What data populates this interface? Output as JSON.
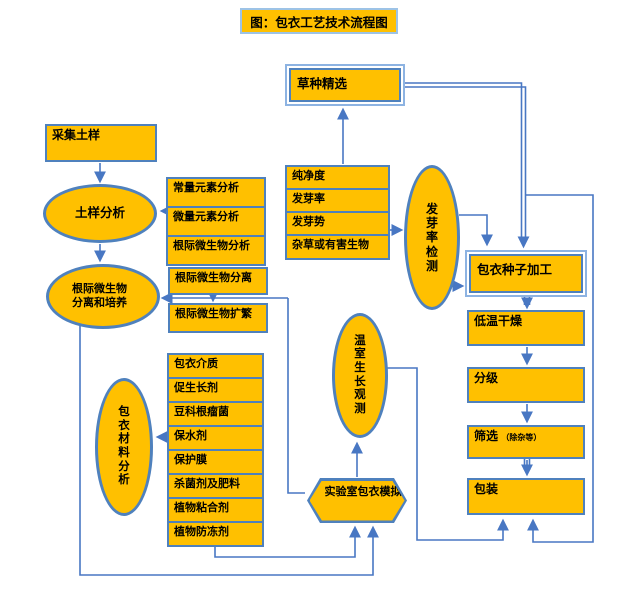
{
  "title": "图：包衣工艺技术流程图",
  "nodes": {
    "seed_selection": "草种精选",
    "collect_soil": "采集土样",
    "soil_analysis": "土样分析",
    "rhizo_culture": "根际微生物分离和培养",
    "germination_test": "发芽率检测",
    "coated_seed_processing": "包衣种子加工",
    "low_temp_drying": "低温干燥",
    "grading": "分级",
    "sieving": "筛选",
    "sieving_note": "（除杂等）",
    "packing": "包装",
    "material_analysis": "包衣材料分析",
    "greenhouse_observation": "温室生长观测",
    "lab_coating_simulation": "实验室包衣模拟"
  },
  "soil_tests": [
    "常量元素分析",
    "微量元素分析",
    "根际微生物分析"
  ],
  "seed_tests": [
    "纯净度",
    "发芽率",
    "发芽势",
    "杂草或有害生物"
  ],
  "rhizo_steps": [
    "根际微生物分离",
    "根际微生物扩繁"
  ],
  "materials": [
    "包衣介质",
    "促生长剂",
    "豆科根瘤菌",
    "保水剂",
    "保护膜",
    "杀菌剂及肥料",
    "植物粘合剂",
    "植物防冻剂"
  ],
  "colors": {
    "node_fill": "#FFC000",
    "node_border": "#4F81BD",
    "double_border_outer": "#8DB3E2",
    "line": "#4877C3",
    "title_border": "#9DC3E6"
  }
}
